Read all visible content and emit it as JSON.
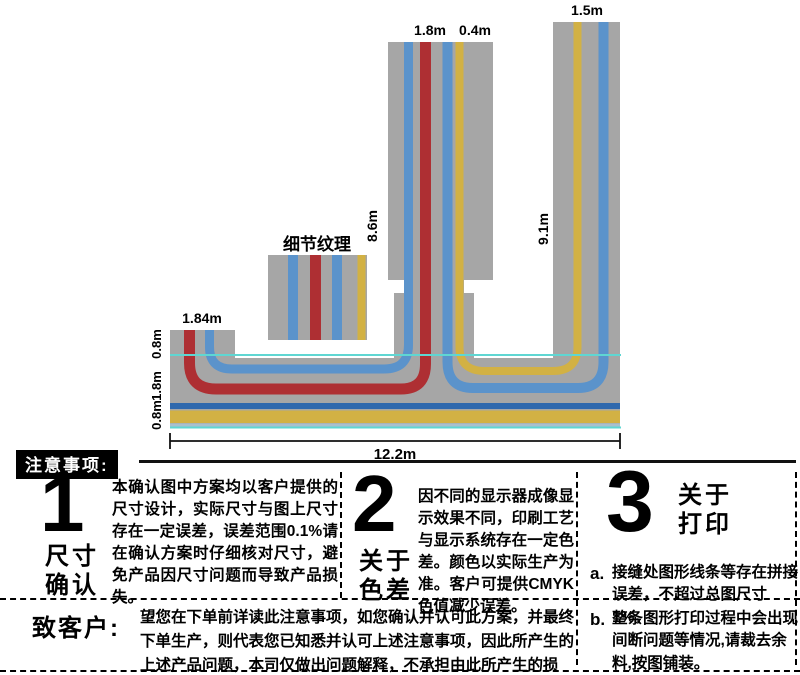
{
  "colors": {
    "gray": "#a6a6a6",
    "red": "#ae2f33",
    "blue": "#5b93cb",
    "yellow": "#d2b144",
    "darkblue": "#2f68ad",
    "cyan": "#5fd6d2",
    "pale": "#a9c0cd",
    "ink": "#000000"
  },
  "diagram": {
    "dims": {
      "bar1_w1": "1.8m",
      "bar1_w2": "0.4m",
      "bar2_w": "1.5m",
      "bar1_h": "8.6m",
      "bar2_h": "9.1m",
      "stub_w": "1.84m",
      "side_top": "0.8m",
      "side_mid": "1.8m",
      "side_bottom": "0.8m",
      "total_w": "12.2m"
    },
    "texture_label": "细节纹理"
  },
  "notice": {
    "header": "注意事项:",
    "sections": [
      {
        "number": "1",
        "title_line1": "尺寸",
        "title_line2": "确认",
        "body": "本确认图中方案均以客户提供的尺寸设计，实际尺寸与图上尺寸存在一定误差，误差范围0.1%请在确认方案时仔细核对尺寸，避免产品因尺寸问题而导致产品损失。"
      },
      {
        "number": "2",
        "title_line1": "关于",
        "title_line2": "色差",
        "body": "因不同的显示器成像显示效果不同，印刷工艺与显示系统存在一定色差。颜色以实际生产为准。客户可提供CMYK色值减少误差。"
      },
      {
        "number": "3",
        "title_line1": "关于",
        "title_line2": "打印",
        "item_a_label": "a.",
        "item_a": "接缝处图形线条等存在拼接误差，不超过总图尺寸1%。",
        "item_b_label": "b.",
        "item_b": "整条图形打印过程中会出现间断问题等情况,请裁去余料,按图铺装。"
      }
    ],
    "customer": {
      "title": "致客户:",
      "body": "望您在下单前详读此注意事项，如您确认并认可此方案，并最终下单生产，则代表您已知悉并认可上述注意事项，因此所产生的上述产品问题，本司仅做出问题解释，不承担由此所产生的损失。"
    }
  }
}
